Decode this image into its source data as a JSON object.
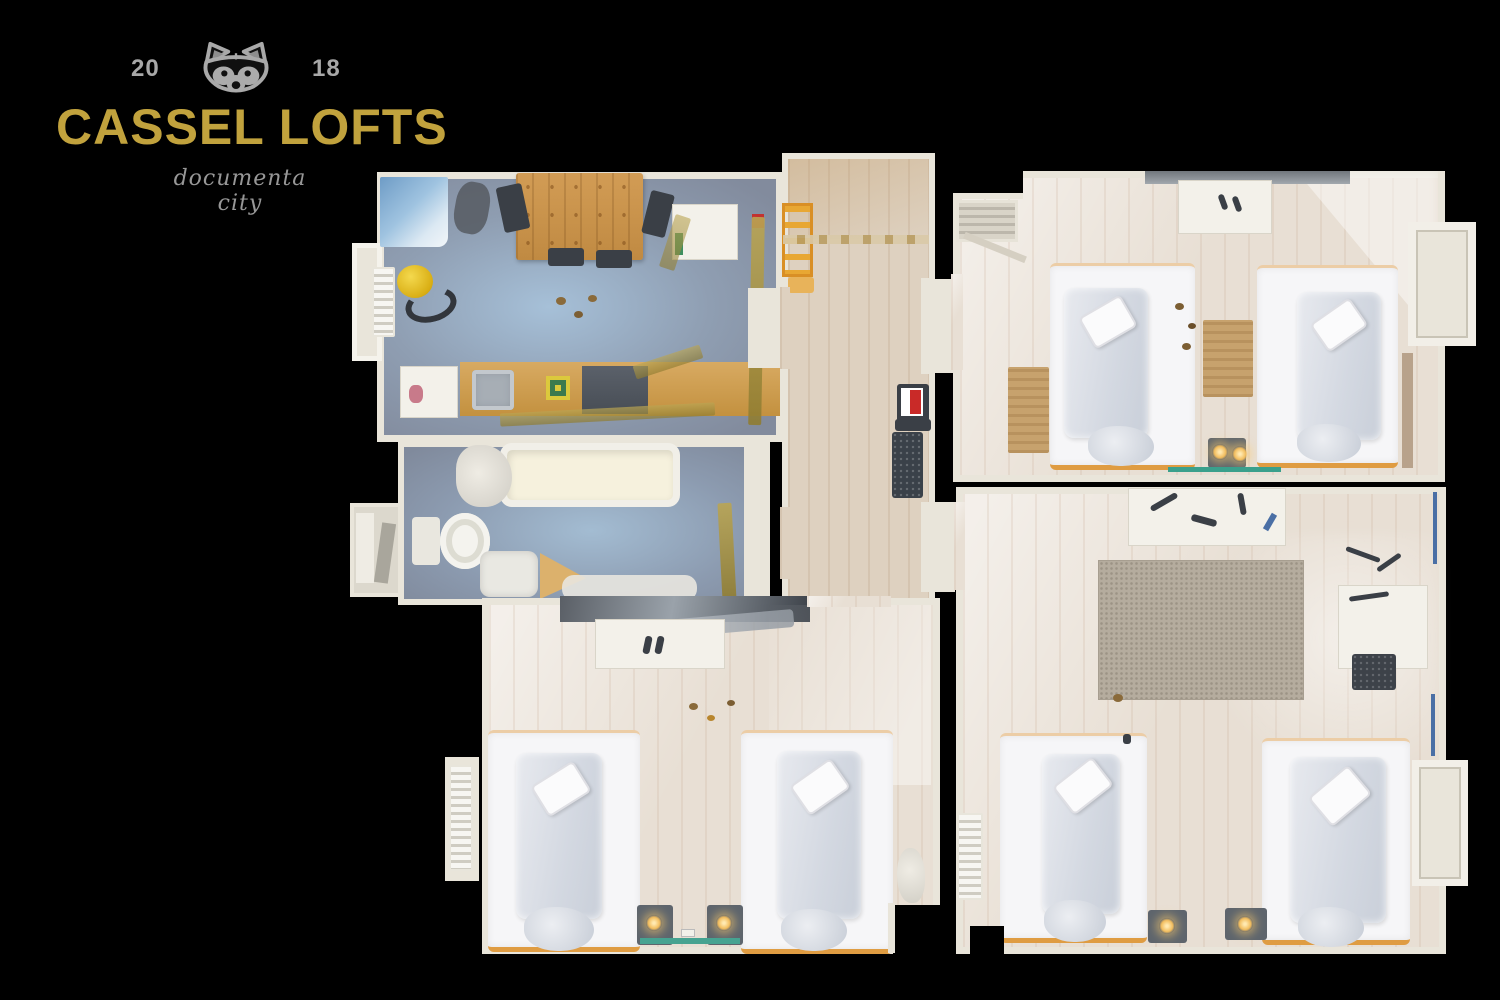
{
  "logo": {
    "year_left": "20",
    "year_right": "18",
    "title": "CASSEL LOFTS",
    "subtitle": "documenta city",
    "icon": "raccoon-icon",
    "colors": {
      "title": "#c1a23d",
      "years": "#a8a8a8",
      "subtitle": "#979797"
    }
  },
  "floorplan": {
    "view": "top-down-apartment-scan",
    "colors": {
      "walls": "#e9e5da",
      "wood_floor": "#e8dfd4",
      "hall_floor": "#ded1c0",
      "kitchen_floor": "#8f9eb2",
      "bed_frame": "#df9c42",
      "tape": "#a6923c",
      "lamp_glow": "#f2bd5e"
    },
    "rooms": [
      {
        "id": "kitchen-living-room",
        "floor": "blue-gray",
        "features": [
          "dining-table",
          "kitchen-counter",
          "sink",
          "stove",
          "fridge",
          "radiator",
          "desk"
        ]
      },
      {
        "id": "bathroom",
        "floor": "blue-gray",
        "features": [
          "bathtub",
          "toilet",
          "washbasin"
        ]
      },
      {
        "id": "hallway",
        "floor": "light-wood",
        "features": [
          "ladder",
          "doormat",
          "sign"
        ]
      },
      {
        "id": "bedroom-top-right",
        "floor": "light-wood",
        "beds": 2,
        "features": [
          "desk",
          "rugs",
          "bay-window",
          "lamps"
        ]
      },
      {
        "id": "bedroom-bottom-right",
        "floor": "light-wood",
        "beds": 2,
        "features": [
          "wardrobe",
          "rug",
          "desk",
          "chair",
          "radiator",
          "bay-window",
          "lamps"
        ]
      },
      {
        "id": "bedroom-bottom-left",
        "floor": "light-wood",
        "beds": 2,
        "features": [
          "desk",
          "mirror",
          "radiator",
          "lamps"
        ]
      }
    ]
  }
}
